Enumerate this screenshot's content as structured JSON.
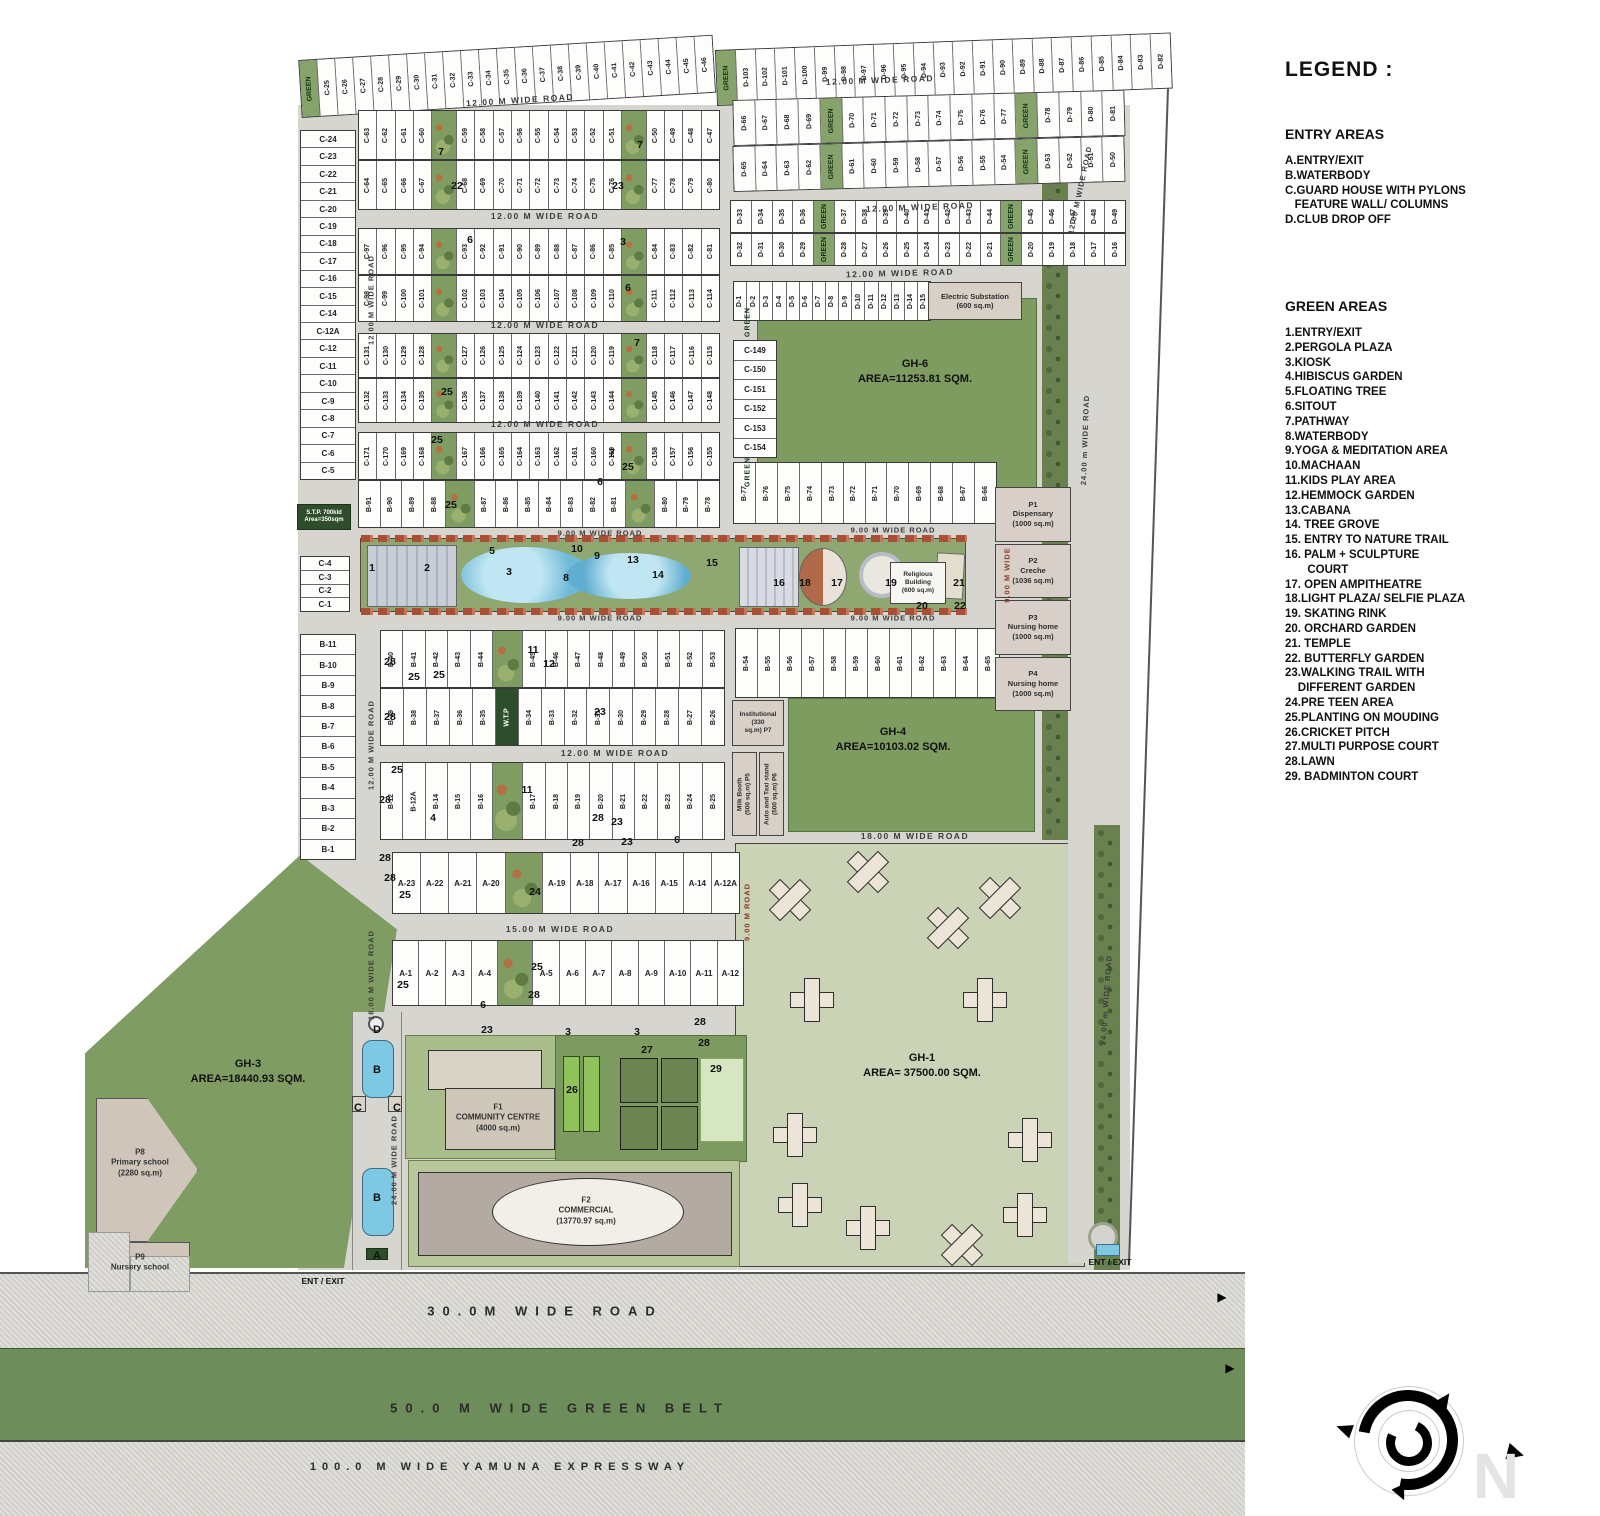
{
  "legend": {
    "title": "LEGEND :",
    "entry_title": "ENTRY AREAS",
    "entry_items": [
      "A.ENTRY/EXIT",
      "B.WATERBODY",
      "C.GUARD HOUSE WITH PYLONS",
      "   FEATURE WALL/ COLUMNS",
      "D.CLUB DROP OFF"
    ],
    "green_title": "GREEN AREAS",
    "green_items": [
      "1.ENTRY/EXIT",
      "2.PERGOLA PLAZA",
      "3.KIOSK",
      "4.HIBISCUS GARDEN",
      "5.FLOATING TREE",
      "6.SITOUT",
      "7.PATHWAY",
      "8.WATERBODY",
      "9.YOGA & MEDITATION AREA",
      "10.MACHAAN",
      "11.KIDS PLAY AREA",
      "12.HEMMOCK GARDEN",
      "13.CABANA",
      "14. TREE GROVE",
      "15. ENTRY TO NATURE TRAIL",
      "16. PALM + SCULPTURE",
      "       COURT",
      "17. OPEN AMPITHEATRE",
      "18.LIGHT PLAZA/ SELFIE PLAZA",
      "19. SKATING RINK",
      "20. ORCHARD GARDEN",
      "21. TEMPLE",
      "22. BUTTERFLY GARDEN",
      "23.WALKING TRAIL WITH",
      "    DIFFERENT GARDEN",
      "24.PRE TEEN AREA",
      "25.PLANTING ON MOUDING",
      "26.CRICKET PITCH",
      "27.MULTI PURPOSE COURT",
      "28.LAWN",
      "29. BADMINTON COURT"
    ]
  },
  "plots": {
    "c_top": [
      "GREEN",
      "C-25",
      "C-26",
      "C-27",
      "C-28",
      "C-29",
      "C-30",
      "C-31",
      "C-32",
      "C-33",
      "C-34",
      "C-35",
      "C-36",
      "C-37",
      "C-38",
      "C-39",
      "C-40",
      "C-41",
      "C-42",
      "C-43",
      "C-44",
      "C-45",
      "C-46"
    ],
    "d_top": [
      "GREEN",
      "D-103",
      "D-102",
      "D-101",
      "D-100",
      "D-99",
      "D-98",
      "D-97",
      "D-96",
      "D-95",
      "D-94",
      "D-93",
      "D-92",
      "D-91",
      "D-90",
      "D-89",
      "D-88",
      "D-87",
      "D-86",
      "D-85",
      "D-84",
      "D-83",
      "D-82"
    ],
    "d2a": [
      "D-66",
      "D-67",
      "D-68",
      "D-69",
      "GREEN",
      "D-70",
      "D-71",
      "D-72",
      "D-73",
      "D-74",
      "D-75",
      "D-76",
      "D-77",
      "GREEN",
      "D-78",
      "D-79",
      "D-80",
      "D-81"
    ],
    "d2b": [
      "D-65",
      "D-64",
      "D-63",
      "D-62",
      "GREEN",
      "D-61",
      "D-60",
      "D-59",
      "D-58",
      "D-57",
      "D-56",
      "D-55",
      "D-54",
      "GREEN",
      "D-53",
      "D-52",
      "D-51",
      "D-50"
    ],
    "d3a": [
      "D-33",
      "D-34",
      "D-35",
      "D-36",
      "GREEN",
      "D-37",
      "D-38",
      "D-39",
      "D-40",
      "D-41",
      "D-42",
      "D-43",
      "D-44",
      "GREEN",
      "D-45",
      "D-46",
      "D-47",
      "D-48",
      "D-49"
    ],
    "d3b": [
      "D-32",
      "D-31",
      "D-30",
      "D-29",
      "GREEN",
      "D-28",
      "D-27",
      "D-26",
      "D-25",
      "D-24",
      "D-23",
      "D-22",
      "D-21",
      "GREEN",
      "D-20",
      "D-19",
      "D-18",
      "D-17",
      "D-16"
    ],
    "d_row4": [
      "D-1",
      "D-2",
      "D-3",
      "D-4",
      "D-5",
      "D-6",
      "D-7",
      "D-8",
      "D-9",
      "D-10",
      "D-11",
      "D-12",
      "D-13",
      "D-14",
      "D-15"
    ],
    "c_col": [
      "C-24",
      "C-23",
      "C-22",
      "C-21",
      "C-20",
      "C-19",
      "C-18",
      "C-17",
      "C-16",
      "C-15",
      "C-14",
      "C-12A",
      "C-12",
      "C-11",
      "C-10",
      "C-9",
      "C-8",
      "C-7",
      "C-6",
      "C-5"
    ],
    "c_col2": [
      "C-4",
      "C-3",
      "C-2",
      "C-1"
    ],
    "b_col": [
      "B-11",
      "B-10",
      "B-9",
      "B-8",
      "B-7",
      "B-6",
      "B-5",
      "B-4",
      "B-3",
      "B-2",
      "B-1"
    ],
    "r1a": [
      "C-63",
      "C-62",
      "C-61",
      "C-60",
      "GARDEN",
      "C-59",
      "C-58",
      "C-57",
      "C-56",
      "C-55",
      "C-54",
      "C-53",
      "C-52",
      "C-51",
      "GARDEN",
      "C-50",
      "C-49",
      "C-48",
      "C-47"
    ],
    "r1b": [
      "C-64",
      "C-65",
      "C-66",
      "C-67",
      "GARDEN",
      "C-68",
      "C-69",
      "C-70",
      "C-71",
      "C-72",
      "C-73",
      "C-74",
      "C-75",
      "C-76",
      "GARDEN",
      "C-77",
      "C-78",
      "C-79",
      "C-80"
    ],
    "r2a": [
      "C-97",
      "C-96",
      "C-95",
      "C-94",
      "GARDEN",
      "C-93",
      "C-92",
      "C-91",
      "C-90",
      "C-89",
      "C-88",
      "C-87",
      "C-86",
      "C-85",
      "GARDEN",
      "C-84",
      "C-83",
      "C-82",
      "C-81"
    ],
    "r2b": [
      "C-98",
      "C-99",
      "C-100",
      "C-101",
      "GARDEN",
      "C-102",
      "C-103",
      "C-104",
      "C-105",
      "C-106",
      "C-107",
      "C-108",
      "C-109",
      "C-110",
      "GARDEN",
      "C-111",
      "C-112",
      "C-113",
      "C-114"
    ],
    "r3a": [
      "C-131",
      "C-130",
      "C-129",
      "C-128",
      "GARDEN",
      "C-127",
      "C-126",
      "C-125",
      "C-124",
      "C-123",
      "C-122",
      "C-121",
      "C-120",
      "C-119",
      "GARDEN",
      "C-118",
      "C-117",
      "C-116",
      "C-115"
    ],
    "r3b": [
      "C-132",
      "C-133",
      "C-134",
      "C-135",
      "GARDEN",
      "C-136",
      "C-137",
      "C-138",
      "C-139",
      "C-140",
      "C-141",
      "C-142",
      "C-143",
      "C-144",
      "GARDEN",
      "C-145",
      "C-146",
      "C-147",
      "C-148"
    ],
    "r4a": [
      "C-171",
      "C-170",
      "C-169",
      "C-168",
      "GARDEN",
      "C-167",
      "C-166",
      "C-165",
      "C-164",
      "C-163",
      "C-162",
      "C-161",
      "C-160",
      "C-159",
      "GARDEN",
      "C-158",
      "C-157",
      "C-156",
      "C-155"
    ],
    "r4b": [
      "B-91",
      "B-90",
      "B-89",
      "B-88",
      "GARDEN",
      "B-87",
      "B-86",
      "B-85",
      "B-84",
      "B-83",
      "B-82",
      "B-81",
      "GARDEN",
      "B-80",
      "B-79",
      "B-78"
    ],
    "c149": [
      "C-149",
      "C-150",
      "C-151",
      "C-152",
      "C-153",
      "C-154"
    ],
    "b77": [
      "B-77",
      "B-76",
      "B-75",
      "B-74",
      "B-73",
      "B-72",
      "B-71",
      "B-70",
      "B-69",
      "B-68",
      "B-67",
      "B-66"
    ],
    "bm1a": [
      "B-40",
      "B-41",
      "B-42",
      "B-43",
      "B-44",
      "GARDEN",
      "B-45",
      "B-46",
      "B-47",
      "B-48",
      "B-49",
      "B-50",
      "B-51",
      "B-52",
      "B-53"
    ],
    "bm1b": [
      "B-39",
      "B-38",
      "B-37",
      "B-36",
      "B-35",
      "W.T.P",
      "B-34",
      "B-33",
      "B-32",
      "B-31",
      "B-30",
      "B-29",
      "B-28",
      "B-27",
      "B-26"
    ],
    "bm2": [
      "B-12",
      "B-12A",
      "B-14",
      "B-15",
      "B-16",
      "GARDEN",
      "B-17",
      "B-18",
      "B-19",
      "B-20",
      "B-21",
      "B-22",
      "B-23",
      "B-24",
      "B-25"
    ],
    "b_right": [
      "B-54",
      "B-55",
      "B-56",
      "B-57",
      "B-58",
      "B-59",
      "B-60",
      "B-61",
      "B-62",
      "B-63",
      "B-64",
      "B-65"
    ],
    "a1": [
      "A-23",
      "A-22",
      "A-21",
      "A-20",
      "GARDEN",
      "A-19",
      "A-18",
      "A-17",
      "A-16",
      "A-15",
      "A-14",
      "A-12A"
    ],
    "a2": [
      "A-1",
      "A-2",
      "A-3",
      "A-4",
      "GARDEN",
      "A-5",
      "A-6",
      "A-7",
      "A-8",
      "A-9",
      "A-10",
      "A-11",
      "A-12"
    ]
  },
  "facilities": {
    "electric": "Electric Substation\n(600 sq.m)",
    "religious": "Religious\nBuilding\n(600 sq.m)",
    "stp": "S.T.P. 700kld\nArea=350sqm",
    "p7": "Institutional (330\nsq.m)          P7",
    "p5": "Milk Booth\n(500 sq.m)  P5",
    "p6": "Auto and Taxi stand\n(500 sq.m)  P6"
  },
  "pboxes": [
    {
      "id": "P1",
      "name": "Dispensary",
      "area": "(1000 sq.m)"
    },
    {
      "id": "P2",
      "name": "Creche",
      "area": "(1036 sq.m)"
    },
    {
      "id": "P3",
      "name": "Nursing home",
      "area": "(1000 sq.m)"
    },
    {
      "id": "P4",
      "name": "Nursing home",
      "area": "(1000 sq.m)"
    }
  ],
  "markers": [
    {
      "x": 520,
      "y": 100,
      "t": "12.00 M WIDE ROAD",
      "c": "road",
      "r": -3.5
    },
    {
      "x": 880,
      "y": 80,
      "t": "12.00 M WIDE ROAD",
      "c": "road",
      "r": -2
    },
    {
      "x": 920,
      "y": 207,
      "t": "12.00 M WIDE ROAD",
      "c": "road",
      "r": -2
    },
    {
      "x": 900,
      "y": 273,
      "t": "12.00 M WIDE ROAD",
      "c": "road",
      "r": -1.5
    },
    {
      "x": 545,
      "y": 216,
      "t": "12.00 M WIDE ROAD",
      "c": "road"
    },
    {
      "x": 545,
      "y": 325,
      "t": "12.00 M WIDE ROAD",
      "c": "road"
    },
    {
      "x": 545,
      "y": 424,
      "t": "12.00 M WIDE ROAD",
      "c": "road"
    },
    {
      "x": 615,
      "y": 753,
      "t": "12.00 M WIDE ROAD",
      "c": "road"
    },
    {
      "x": 560,
      "y": 929,
      "t": "15.00 M WIDE ROAD",
      "c": "road"
    },
    {
      "x": 915,
      "y": 836,
      "t": "18.00 M WIDE ROAD",
      "c": "road"
    },
    {
      "x": 600,
      "y": 533,
      "t": "9.00 M WIDE ROAD",
      "c": "roads"
    },
    {
      "x": 893,
      "y": 530,
      "t": "9.00 M WIDE ROAD",
      "c": "roads"
    },
    {
      "x": 600,
      "y": 618,
      "t": "9.00 M WIDE ROAD",
      "c": "roads"
    },
    {
      "x": 893,
      "y": 618,
      "t": "9.00 M WIDE ROAD",
      "c": "roads"
    },
    {
      "x": 371,
      "y": 300,
      "t": "12.00 M WIDE ROAD",
      "c": "roads",
      "r": -90
    },
    {
      "x": 371,
      "y": 745,
      "t": "12.00 M WIDE ROAD",
      "c": "roads",
      "r": -90
    },
    {
      "x": 371,
      "y": 975,
      "t": "18.00 M WIDE ROAD",
      "c": "roads",
      "r": -90
    },
    {
      "x": 394,
      "y": 1160,
      "t": "24.00 M WIDE ROAD",
      "c": "roads",
      "r": -90
    },
    {
      "x": 747,
      "y": 912,
      "t": "9.00 M ROAD",
      "c": "roadr",
      "r": -90
    },
    {
      "x": 1007,
      "y": 575,
      "t": "9.00 M WIDE",
      "c": "roadr",
      "r": -90
    },
    {
      "x": 1080,
      "y": 190,
      "t": "12.00 M WIDE ROAD",
      "c": "roads",
      "r": -78
    },
    {
      "x": 1085,
      "y": 440,
      "t": "24.00 m WIDE ROAD",
      "c": "roads",
      "r": -88
    },
    {
      "x": 1106,
      "y": 1000,
      "t": "24.00 m WIDE ROAD",
      "c": "roads",
      "r": -86
    },
    {
      "x": 748,
      "y": 322,
      "t": "GREEN",
      "c": "greenv",
      "r": -90
    },
    {
      "x": 748,
      "y": 472,
      "t": "GREEN",
      "c": "greenv",
      "r": -90
    },
    {
      "x": 915,
      "y": 372,
      "t": "GH-6\nAREA=11253.81 SQM.",
      "c": "area"
    },
    {
      "x": 893,
      "y": 740,
      "t": "GH-4\nAREA=10103.02 SQM.",
      "c": "area"
    },
    {
      "x": 922,
      "y": 1066,
      "t": "GH-1\nAREA= 37500.00 SQM.",
      "c": "area"
    },
    {
      "x": 248,
      "y": 1072,
      "t": "GH-3\nAREA=18440.93 SQM.",
      "c": "area"
    },
    {
      "x": 140,
      "y": 1163,
      "t": "P8\nPrimary school\n(2280 sq.m)",
      "c": "areaS"
    },
    {
      "x": 140,
      "y": 1263,
      "t": "P9\nNursery school",
      "c": "areaS"
    },
    {
      "x": 498,
      "y": 1118,
      "t": "F1\nCOMMUNITY CENTRE\n(4000 sq.m)",
      "c": "areaS"
    },
    {
      "x": 586,
      "y": 1211,
      "t": "F2\nCOMMERCIAL\n(13770.97 sq.m)",
      "c": "areaS"
    },
    {
      "x": 377,
      "y": 1030,
      "t": "D",
      "c": "letter"
    },
    {
      "x": 377,
      "y": 1070,
      "t": "B",
      "c": "letter"
    },
    {
      "x": 358,
      "y": 1108,
      "t": "C",
      "c": "letter"
    },
    {
      "x": 397,
      "y": 1108,
      "t": "C",
      "c": "letter"
    },
    {
      "x": 377,
      "y": 1198,
      "t": "B",
      "c": "letter"
    },
    {
      "x": 377,
      "y": 1256,
      "t": "A",
      "c": "letter"
    },
    {
      "x": 323,
      "y": 1281,
      "t": "ENT / EXIT",
      "c": "ent"
    },
    {
      "x": 1110,
      "y": 1262,
      "t": "ENT / EXIT",
      "c": "ent"
    },
    {
      "x": 545,
      "y": 1311,
      "t": "30.0M WIDE ROAD",
      "c": "band"
    },
    {
      "x": 560,
      "y": 1408,
      "t": "50.0 M WIDE GREEN BELT",
      "c": "band"
    },
    {
      "x": 500,
      "y": 1467,
      "t": "100.0 M WIDE YAMUNA EXPRESSWAY",
      "c": "band2"
    },
    {
      "x": 441,
      "y": 152,
      "t": "7",
      "c": "num"
    },
    {
      "x": 457,
      "y": 186,
      "t": "22",
      "c": "num"
    },
    {
      "x": 618,
      "y": 186,
      "t": "23",
      "c": "num"
    },
    {
      "x": 640,
      "y": 145,
      "t": "7",
      "c": "num"
    },
    {
      "x": 470,
      "y": 240,
      "t": "6",
      "c": "num"
    },
    {
      "x": 623,
      "y": 242,
      "t": "3",
      "c": "num"
    },
    {
      "x": 628,
      "y": 288,
      "t": "6",
      "c": "num"
    },
    {
      "x": 637,
      "y": 343,
      "t": "7",
      "c": "num"
    },
    {
      "x": 447,
      "y": 392,
      "t": "25",
      "c": "num"
    },
    {
      "x": 437,
      "y": 440,
      "t": "25",
      "c": "num"
    },
    {
      "x": 451,
      "y": 505,
      "t": "25",
      "c": "num"
    },
    {
      "x": 612,
      "y": 453,
      "t": "7",
      "c": "num"
    },
    {
      "x": 628,
      "y": 467,
      "t": "25",
      "c": "num"
    },
    {
      "x": 600,
      "y": 482,
      "t": "6",
      "c": "num"
    },
    {
      "x": 372,
      "y": 568,
      "t": "1",
      "c": "num"
    },
    {
      "x": 427,
      "y": 568,
      "t": "2",
      "c": "num"
    },
    {
      "x": 492,
      "y": 551,
      "t": "5",
      "c": "num"
    },
    {
      "x": 509,
      "y": 572,
      "t": "3",
      "c": "num"
    },
    {
      "x": 566,
      "y": 578,
      "t": "8",
      "c": "num"
    },
    {
      "x": 577,
      "y": 549,
      "t": "10",
      "c": "num"
    },
    {
      "x": 597,
      "y": 556,
      "t": "9",
      "c": "num"
    },
    {
      "x": 633,
      "y": 560,
      "t": "13",
      "c": "num"
    },
    {
      "x": 658,
      "y": 575,
      "t": "14",
      "c": "num"
    },
    {
      "x": 712,
      "y": 563,
      "t": "15",
      "c": "num"
    },
    {
      "x": 779,
      "y": 583,
      "t": "16",
      "c": "num"
    },
    {
      "x": 805,
      "y": 583,
      "t": "18",
      "c": "num"
    },
    {
      "x": 837,
      "y": 583,
      "t": "17",
      "c": "num"
    },
    {
      "x": 891,
      "y": 583,
      "t": "19",
      "c": "num"
    },
    {
      "x": 922,
      "y": 606,
      "t": "20",
      "c": "num"
    },
    {
      "x": 959,
      "y": 583,
      "t": "21",
      "c": "num"
    },
    {
      "x": 960,
      "y": 606,
      "t": "22",
      "c": "num"
    },
    {
      "x": 390,
      "y": 662,
      "t": "28",
      "c": "num"
    },
    {
      "x": 414,
      "y": 677,
      "t": "25",
      "c": "num"
    },
    {
      "x": 439,
      "y": 675,
      "t": "25",
      "c": "num"
    },
    {
      "x": 533,
      "y": 650,
      "t": "11",
      "c": "num"
    },
    {
      "x": 549,
      "y": 664,
      "t": "12",
      "c": "num"
    },
    {
      "x": 600,
      "y": 712,
      "t": "23",
      "c": "num"
    },
    {
      "x": 390,
      "y": 717,
      "t": "28",
      "c": "num"
    },
    {
      "x": 397,
      "y": 770,
      "t": "25",
      "c": "num"
    },
    {
      "x": 385,
      "y": 800,
      "t": "28",
      "c": "num"
    },
    {
      "x": 433,
      "y": 818,
      "t": "4",
      "c": "num"
    },
    {
      "x": 527,
      "y": 790,
      "t": "11",
      "c": "num"
    },
    {
      "x": 598,
      "y": 818,
      "t": "28",
      "c": "num"
    },
    {
      "x": 617,
      "y": 822,
      "t": "23",
      "c": "num"
    },
    {
      "x": 385,
      "y": 858,
      "t": "28",
      "c": "num"
    },
    {
      "x": 390,
      "y": 878,
      "t": "28",
      "c": "num"
    },
    {
      "x": 405,
      "y": 895,
      "t": "25",
      "c": "num"
    },
    {
      "x": 535,
      "y": 892,
      "t": "24",
      "c": "num"
    },
    {
      "x": 578,
      "y": 843,
      "t": "28",
      "c": "num"
    },
    {
      "x": 627,
      "y": 842,
      "t": "23",
      "c": "num"
    },
    {
      "x": 677,
      "y": 840,
      "t": "6",
      "c": "num"
    },
    {
      "x": 403,
      "y": 985,
      "t": "25",
      "c": "num"
    },
    {
      "x": 537,
      "y": 967,
      "t": "25",
      "c": "num"
    },
    {
      "x": 534,
      "y": 995,
      "t": "28",
      "c": "num"
    },
    {
      "x": 483,
      "y": 1005,
      "t": "6",
      "c": "num"
    },
    {
      "x": 487,
      "y": 1030,
      "t": "23",
      "c": "num"
    },
    {
      "x": 568,
      "y": 1032,
      "t": "3",
      "c": "num"
    },
    {
      "x": 637,
      "y": 1032,
      "t": "3",
      "c": "num"
    },
    {
      "x": 700,
      "y": 1022,
      "t": "28",
      "c": "num"
    },
    {
      "x": 647,
      "y": 1050,
      "t": "27",
      "c": "num"
    },
    {
      "x": 572,
      "y": 1090,
      "t": "26",
      "c": "num"
    },
    {
      "x": 716,
      "y": 1069,
      "t": "29",
      "c": "num"
    },
    {
      "x": 704,
      "y": 1043,
      "t": "28",
      "c": "num"
    },
    {
      "x": 1222,
      "y": 1297,
      "t": "▶",
      "c": "arrow2"
    },
    {
      "x": 1230,
      "y": 1368,
      "t": "▶",
      "c": "arrow2"
    },
    {
      "x": 1516,
      "y": 1452,
      "t": "▶",
      "c": "arrow",
      "r": 15
    },
    {
      "x": 1496,
      "y": 1476,
      "t": "N",
      "c": "wm"
    }
  ],
  "towers": [
    {
      "x": 790,
      "y": 900,
      "r": 45
    },
    {
      "x": 868,
      "y": 872,
      "r": 45
    },
    {
      "x": 1000,
      "y": 898,
      "r": 45
    },
    {
      "x": 948,
      "y": 928,
      "r": 45
    },
    {
      "x": 812,
      "y": 1000,
      "r": 0
    },
    {
      "x": 985,
      "y": 1000,
      "r": 0
    },
    {
      "x": 795,
      "y": 1135,
      "r": 0
    },
    {
      "x": 800,
      "y": 1205,
      "r": 0
    },
    {
      "x": 868,
      "y": 1228,
      "r": 0
    },
    {
      "x": 1030,
      "y": 1140,
      "r": 0
    },
    {
      "x": 1025,
      "y": 1215,
      "r": 0
    },
    {
      "x": 962,
      "y": 1245,
      "r": 45
    }
  ]
}
